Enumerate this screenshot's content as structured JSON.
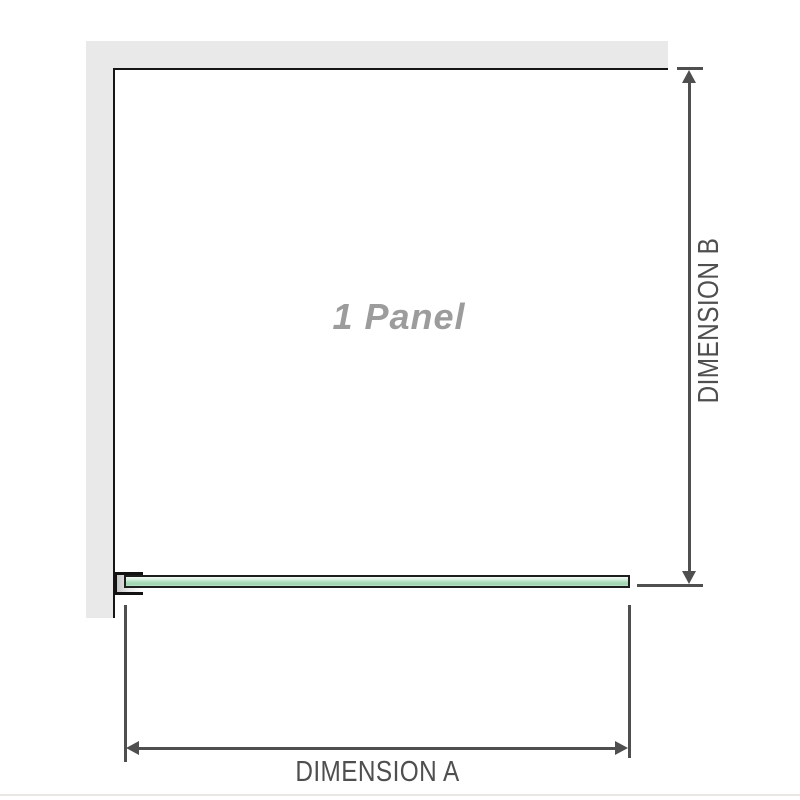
{
  "diagram": {
    "panel_label": "1 Panel",
    "dimension_a": {
      "label": "DIMENSION A"
    },
    "dimension_b": {
      "label": "DIMENSION B"
    }
  },
  "colors": {
    "wall_gray": "#e9e9e9",
    "panel_border": "#161616",
    "glass_green": "#a8dab8",
    "glass_border": "#1d1d1d",
    "dimension_line": "#4f4f4f",
    "dimension_text": "#4f4f4f",
    "panel_label_text": "#9c9c9c",
    "background": "#ffffff"
  }
}
